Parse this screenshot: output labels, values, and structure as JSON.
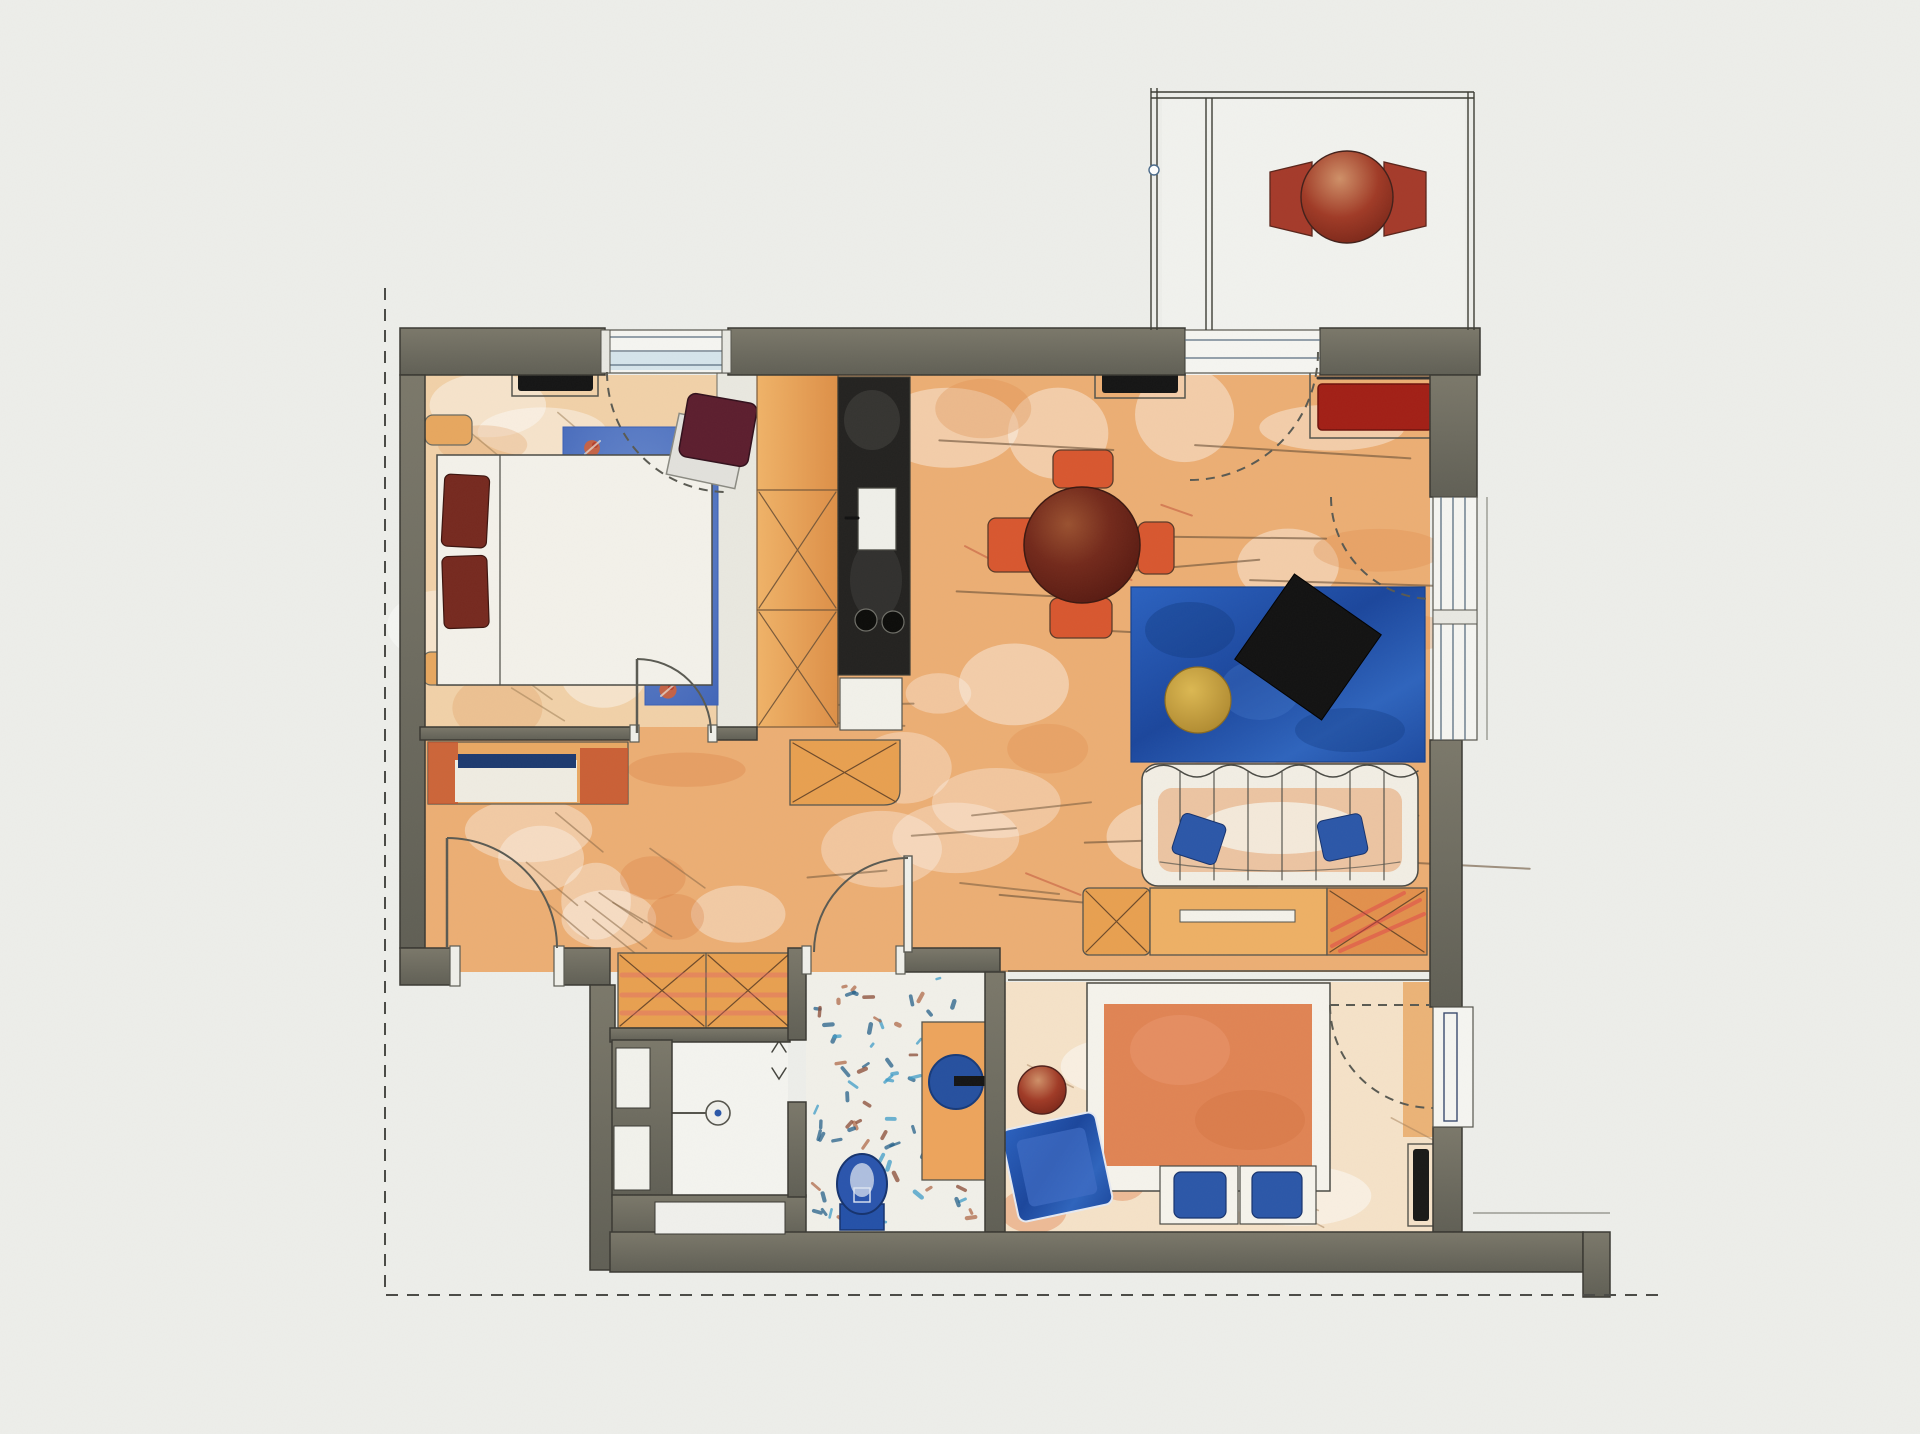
{
  "document": {
    "kind": "apartment floor plan",
    "style": "hand-drawn colored pencil sketch, scanned paper",
    "view": "top-down plan",
    "visible_text": "none"
  },
  "palette": {
    "paper": "#edeeea",
    "wall_fill": "#716f63",
    "wall_outline": "#3a3933",
    "wood_floor": "#ecae74",
    "pale_floor_bedroom": "#f1d1a8",
    "pale_floor_bedroom2": "#f5e2c8",
    "ink_line": "#4a4a44",
    "furniture_orange": "#e59a4f",
    "chair_red_orange": "#d8572f",
    "deep_maroon": "#6e2418",
    "wine_chair": "#5c1e2e",
    "accent_blue_table": "#2257b0",
    "fixture_blue": "#2451a8",
    "pillow_maroon": "#76291f",
    "radiator_red": "#a21f16",
    "radiator_black": "#151515",
    "yellow_bowl": "#c9a03b",
    "rug_blue": "#4a6fc0",
    "speckle_blue": "#3f9dc8",
    "speckle_brown": "#8a4a34"
  },
  "rooms": [
    {
      "id": "bedroom-main",
      "position": "top-left",
      "furniture": [
        "double-bed",
        "two-maroon-pillows",
        "two-nightstands",
        "floral-blue-runner-rug",
        "rotated-desk",
        "wine-red-desk-chair",
        "black-radiator-under-window"
      ]
    },
    {
      "id": "kitchen-niche",
      "position": "top-center",
      "furniture": [
        "tall-orange-cabinet-column-with-x-marks",
        "black-counter-strip",
        "sink",
        "two-burner-cooktop",
        "white-base-cabinet"
      ]
    },
    {
      "id": "entry-hall",
      "position": "left-center",
      "furniture": [
        "entry-sideboard-with-navy-edge",
        "front-door",
        "wood-floor"
      ]
    },
    {
      "id": "living-room",
      "position": "right-center",
      "furniture": [
        "round-maroon-dining-table",
        "four-red-orange-chairs",
        "blue-coffee-table",
        "black-rotated-tv-tray",
        "yellow-bowl",
        "sofa-with-blue-pillows",
        "sideboard-row-with-x-cabinets",
        "black-radiator",
        "red-radiator"
      ]
    },
    {
      "id": "bathroom",
      "position": "bottom-center",
      "furniture": [
        "speckled-tile-floor",
        "blue-toilet",
        "orange-vanity",
        "blue-round-basin-with-tap"
      ]
    },
    {
      "id": "shower-room",
      "position": "bottom-left",
      "furniture": [
        "shower-symbol"
      ]
    },
    {
      "id": "hall-wardrobe-niche",
      "position": "bottom-left-center",
      "furniture": [
        "orange-wardrobe-with-x-marks"
      ]
    },
    {
      "id": "bedroom-second",
      "position": "bottom-right",
      "furniture": [
        "bed-with-orange-duvet",
        "two-blue-stools",
        "rotated-blue-rug",
        "round-red-stool",
        "dark-radiator"
      ]
    },
    {
      "id": "balcony",
      "position": "top-right",
      "furniture": [
        "round-red-table",
        "two-red-chairs",
        "railing-double-lines"
      ]
    }
  ],
  "openings": {
    "entry_door": 1,
    "interior_doors": 2,
    "windows_with_dashed_swing_arcs": 4,
    "balcony_door": 1
  },
  "boundary": {
    "style": "dashed section line",
    "sides": [
      "left",
      "bottom"
    ]
  }
}
